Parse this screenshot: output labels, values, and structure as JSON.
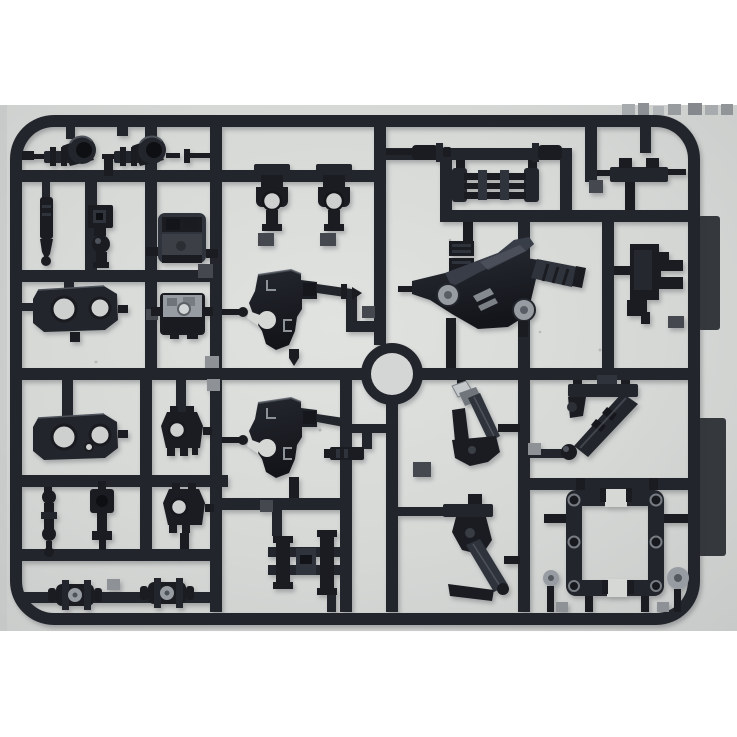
{
  "scene": {
    "type": "photograph",
    "subject": "Plastic model kit runner (sprue) with dark navy injection-molded parts on a light gray surface",
    "layout": "landscape sprue frame with rounded corners, white photo margins top and bottom, two dark tabs on the right edge, circular gate ring near center"
  },
  "colors": {
    "white": "#ffffff",
    "surface": "#d6d8d6",
    "surface-bright": "#e1e3e1",
    "surface-dim": "#c8cac9",
    "plastic": "#23252c",
    "plastic-dark": "#1a1c22",
    "plastic-deep": "#0e0f13",
    "plastic-mid": "#2f333b",
    "plastic-lite": "#4e535b",
    "glare": "#c5c8cb",
    "metal": "#979ca2",
    "hole": "#ced0d0",
    "pad-light": "#8e9297",
    "pad-dark": "#45494f",
    "tab": "#35383d",
    "marking": "#8d9298"
  },
  "sprue": {
    "frame": {
      "x": 10,
      "y": 115,
      "width": 690,
      "height": 510,
      "corner_radius": 44,
      "bar_thickness": 12
    },
    "center_ring": {
      "cx": 392,
      "cy": 374,
      "outer_r": 31,
      "inner_r": 21
    },
    "side_tabs": [
      {
        "id": "tab-upper",
        "x": 698,
        "y": 216,
        "width": 22,
        "height": 114
      },
      {
        "id": "tab-lower",
        "x": 698,
        "y": 418,
        "width": 28,
        "height": 138
      }
    ],
    "part_count": 31,
    "parts": [
      {
        "id": "knuckle-left",
        "label": "swivel ring joint with clevis arm",
        "bbox": [
          22,
          127,
          75,
          40
        ]
      },
      {
        "id": "knuckle-right",
        "label": "swivel ring joint with clevis arm",
        "bbox": [
          102,
          127,
          110,
          50
        ]
      },
      {
        "id": "t-joint-1",
        "label": "T-shaped joint with round hole",
        "bbox": [
          254,
          164,
          36,
          82
        ]
      },
      {
        "id": "t-joint-2",
        "label": "T-shaped joint with round hole",
        "bbox": [
          316,
          164,
          36,
          82
        ]
      },
      {
        "id": "blade",
        "label": "thin vertical blade with ball tip",
        "bbox": [
          40,
          182,
          14,
          84
        ]
      },
      {
        "id": "socket-box",
        "label": "small socket box",
        "bbox": [
          88,
          205,
          25,
          31
        ]
      },
      {
        "id": "ball-joint",
        "label": "ball joint with stem",
        "bbox": [
          92,
          235,
          18,
          33
        ]
      },
      {
        "id": "detail-box-1",
        "label": "rounded detail box with openings",
        "bbox": [
          146,
          213,
          72,
          50
        ]
      },
      {
        "id": "detail-box-2",
        "label": "detail box with bright top face",
        "bbox": [
          151,
          293,
          62,
          46
        ]
      },
      {
        "id": "plate-two-holes-upper",
        "label": "octagonal plate with two round holes",
        "bbox": [
          33,
          286,
          95,
          56
        ]
      },
      {
        "id": "plate-two-holes-lower",
        "label": "octagonal plate with two round holes",
        "bbox": [
          33,
          414,
          95,
          56
        ]
      },
      {
        "id": "hip-block-upper",
        "label": "trapezoid block with hole and feet",
        "bbox": [
          161,
          406,
          53,
          50
        ]
      },
      {
        "id": "hip-block-lower",
        "label": "trapezoid block with hole and feet",
        "bbox": [
          163,
          483,
          53,
          66
        ]
      },
      {
        "id": "armor-shell-upper",
        "label": "curved armor shell with molded letter markings",
        "bbox": [
          222,
          270,
          140,
          96
        ]
      },
      {
        "id": "armor-shell-lower",
        "label": "curved armor shell with molded letter markings",
        "bbox": [
          222,
          398,
          122,
          100
        ]
      },
      {
        "id": "spool-rail",
        "label": "rail with end plates and spools",
        "bbox": [
          452,
          160,
          87,
          42
        ]
      },
      {
        "id": "peg-left",
        "label": "cylindrical peg with collar",
        "bbox": [
          386,
          143,
          65,
          21
        ]
      },
      {
        "id": "peg-right",
        "label": "cylindrical peg with collar",
        "bbox": [
          532,
          143,
          34,
          21
        ]
      },
      {
        "id": "clamp-bracket",
        "label": "clamp bracket with two nubs",
        "bbox": [
          589,
          158,
          97,
          52
        ]
      },
      {
        "id": "leg-frame-plate",
        "label": "large glossy frame plate with two round bosses, vents and ribbed arm",
        "bbox": [
          398,
          222,
          188,
          146
        ]
      },
      {
        "id": "step-bracket",
        "label": "stepped bracket with two prongs",
        "bbox": [
          614,
          244,
          69,
          84
        ]
      },
      {
        "id": "cylinder-strut",
        "label": "diagonal cylinder strut with ball end",
        "bbox": [
          530,
          375,
          108,
          87
        ]
      },
      {
        "id": "piston-upper",
        "label": "piston linkage with bright metal tip",
        "bbox": [
          452,
          380,
          68,
          94
        ]
      },
      {
        "id": "piston-lower",
        "label": "piston linkage with diagonal rod",
        "bbox": [
          398,
          494,
          122,
          107
        ]
      },
      {
        "id": "square-frame",
        "label": "rectangular frame with screw bosses and notched edges",
        "bbox": [
          544,
          478,
          144,
          134
        ]
      },
      {
        "id": "round-peg-small",
        "label": "round peg",
        "bbox": [
          543,
          570,
          16,
          42
        ]
      },
      {
        "id": "round-peg-large",
        "label": "round peg",
        "bbox": [
          667,
          567,
          30,
          45
        ]
      },
      {
        "id": "ladder-block",
        "label": "ladder block with two spools",
        "bbox": [
          268,
          510,
          76,
          102
        ]
      },
      {
        "id": "barrel-connector-1",
        "label": "barrel connector with collars",
        "bbox": [
          48,
          580,
          54,
          30
        ]
      },
      {
        "id": "barrel-connector-2",
        "label": "barrel connector with collars",
        "bbox": [
          140,
          578,
          54,
          30
        ]
      },
      {
        "id": "slider-piece",
        "label": "small ridged slider piece",
        "bbox": [
          324,
          424,
          72,
          36
        ]
      }
    ]
  }
}
